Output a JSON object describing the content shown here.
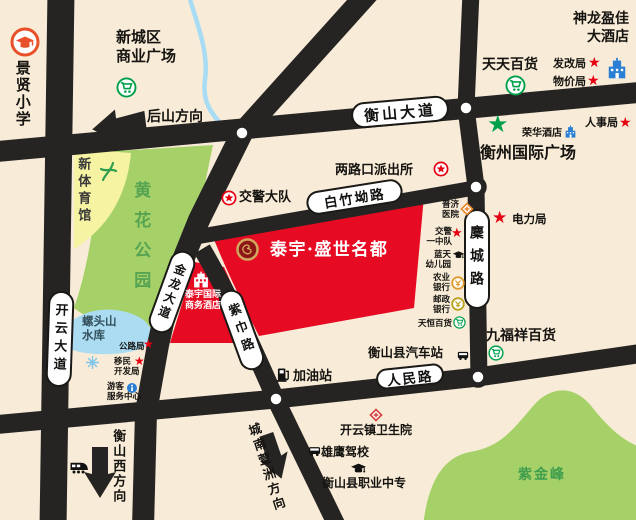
{
  "title": "泰宇·盛世名都 区位示意图",
  "colors": {
    "background": "#f8ecd8",
    "road": "#262423",
    "site_red": "#e60b23",
    "park_green": "#a6d168",
    "water_blue": "#abdcf2",
    "pill_white": "#ffffff",
    "star_red": "#e60012",
    "star_green": "#00a04a"
  },
  "icons": {
    "star": "★"
  },
  "project": {
    "name": "泰宇·盛世名都",
    "hotel_l1": "泰宇国际",
    "hotel_l2": "商务酒店"
  },
  "roads": {
    "hengshan_dadao": "衡山大道",
    "kaiyun_dadao": "开云大道",
    "jinlong_dadao": "金龙大道",
    "baizhuao_lu": "白竹坳路",
    "micheng_lu": "麇城路",
    "zijin_lu": "紫巾路",
    "renmin_lu": "人民路"
  },
  "directions": {
    "houshan": "后山方向",
    "hengshan_west": "衡山西方向",
    "chengnan_xuanzhou": "城南萱洲方向"
  },
  "areas": {
    "huanghua_park": "黄花公园",
    "new_gymnasium": "新体育馆",
    "luotoushan_l1": "螺头山",
    "luotoushan_l2": "水库",
    "zijinfeng": "紫金峰"
  },
  "pois": {
    "jingxian_school": "景贤小学",
    "xinchengqu_l1": "新城区",
    "xinchengqu_l2": "商业广场",
    "shenlong_l1": "神龙盈佳",
    "shenlong_l2": "大酒店",
    "tiantian_baihuo": "天天百货",
    "fagaiju": "发改局",
    "wujiaju": "物价局",
    "renshiju": "人事局",
    "ronghua_hotel": "荣华酒店",
    "hengzhou_plaza": "衡州国际广场",
    "lianglukou_paichusuo": "两路口派出所",
    "jiaojing_dadui": "交警大队",
    "dianliju": "电力局",
    "puji_l1": "普济",
    "puji_l2": "医院",
    "jiaojing_yizhongdui_l1": "交警",
    "jiaojing_yizhongdui_l2": "一中队",
    "lantian_l1": "蓝天",
    "lantian_l2": "幼儿园",
    "nongye_l1": "农业",
    "nongye_l2": "银行",
    "youzheng_l1": "邮政",
    "youzheng_l2": "银行",
    "tianheng_baihuo": "天恒百货",
    "jiufuxiang_baihuo": "九福祥百货",
    "gongluju": "公路局",
    "yimin_l1": "移民",
    "yimin_l2": "开发局",
    "youke_l1": "游客",
    "youke_l2": "服务中心",
    "jiayouzhan": "加油站",
    "hengshanxian_qichezhan": "衡山县汽车站",
    "kaiyunzhen_weishengyuan": "开云镇卫生院",
    "xiongying_jiaxiao": "雄鹰驾校",
    "hengshanxian_zhiye_zhongzhuan": "衡山县职业中专"
  }
}
